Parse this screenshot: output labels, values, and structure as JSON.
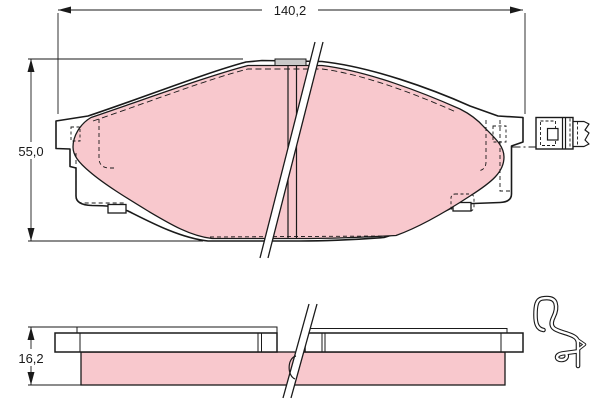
{
  "drawing": {
    "dimensions": {
      "length_label": "140,2",
      "height_label": "55,0",
      "thickness_label": "16,2"
    },
    "colors": {
      "friction_material": "#f8c8cd",
      "outline": "#1a1a1a",
      "backplate": "#ffffff",
      "top_tab_gray": "#c9c9c9",
      "background": "#ffffff"
    },
    "views": {
      "front_view": "brake-pad-front-view",
      "edge_view": "brake-pad-edge-view"
    },
    "icons": {
      "connector": "wear-sensor-connector-icon",
      "clip": "spring-clip-icon"
    }
  }
}
